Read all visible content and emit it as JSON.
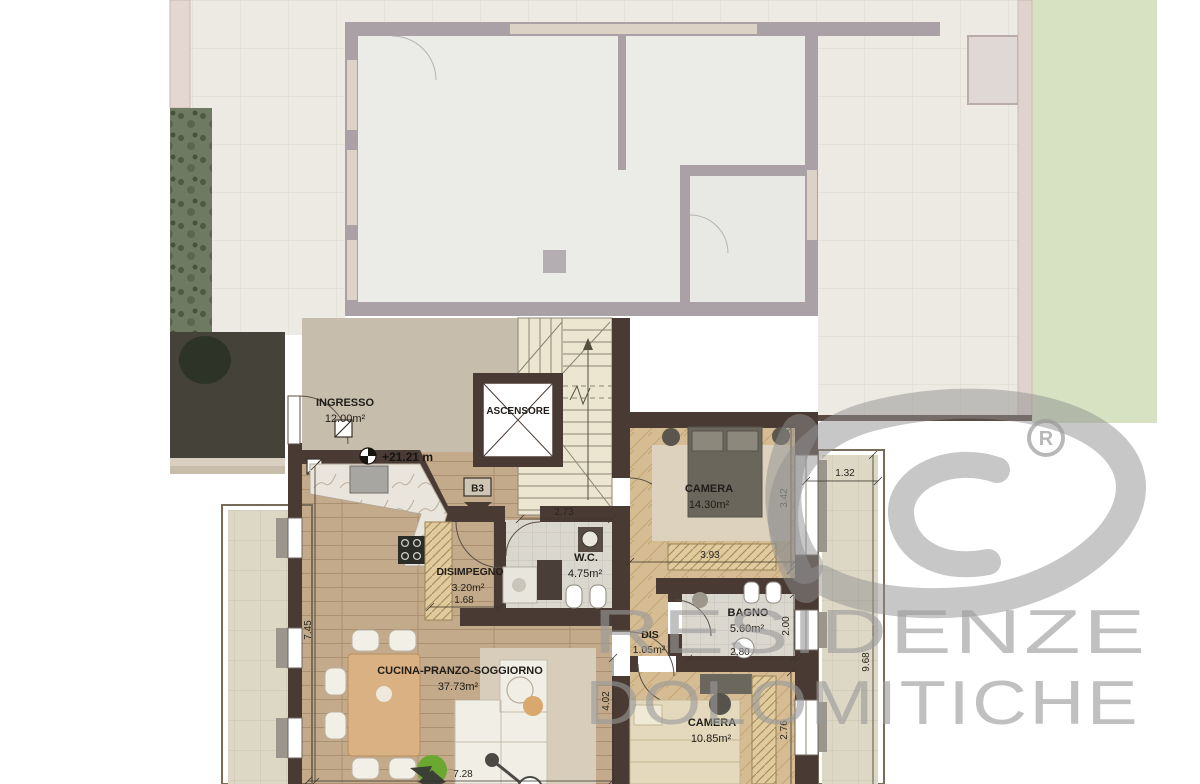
{
  "plan": {
    "unit_label": "B3",
    "elevation": "+21.21 m",
    "rooms": [
      {
        "name": "INGRESSO",
        "area": "12.00m²"
      },
      {
        "name": "ASCENSORE",
        "area": ""
      },
      {
        "name": "CAMERA",
        "area": "14.30m²"
      },
      {
        "name": "DISIMPEGNO",
        "area": "3.20m²"
      },
      {
        "name": "W.C.",
        "area": "4.75m²"
      },
      {
        "name": "BAGNO",
        "area": "5.60m²"
      },
      {
        "name": "DIS",
        "area": "1.05m²"
      },
      {
        "name": "CUCINA-PRANZO-SOGGIORNO",
        "area": "37.73m²"
      },
      {
        "name": "CAMERA",
        "area": "10.85m²"
      }
    ],
    "dimensions": [
      {
        "value": "2.73"
      },
      {
        "value": "3.93"
      },
      {
        "value": "3.42"
      },
      {
        "value": "1.32"
      },
      {
        "value": "2.00"
      },
      {
        "value": "2.80"
      },
      {
        "value": "9.68"
      },
      {
        "value": "2.76"
      },
      {
        "value": "4.02"
      },
      {
        "value": "7.28"
      },
      {
        "value": "1.68"
      },
      {
        "value": "7.45"
      }
    ],
    "colors": {
      "apartment_wall": "#4a3a34",
      "faded_wall": "#a9a1a6",
      "lawn": "#d7e2c3",
      "watermark": "#9a9a9a"
    }
  },
  "watermark": {
    "line1": "RESIDENZE",
    "line2": "DOLOMITICHE",
    "registered": "®",
    "logo": "rd-monogram"
  }
}
